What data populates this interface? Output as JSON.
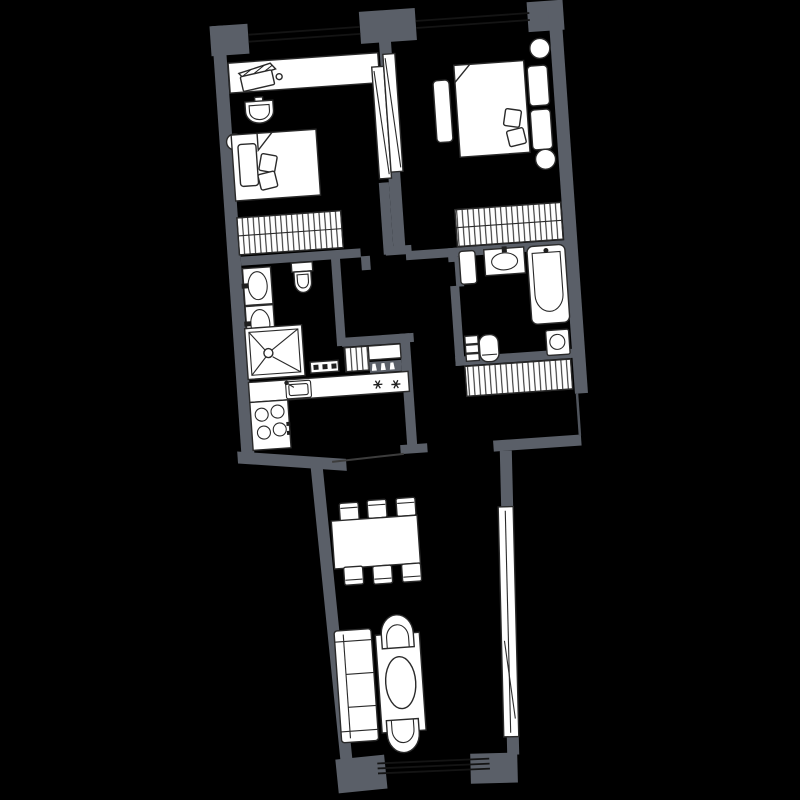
{
  "scene": {
    "kind": "apartment-floor-plan",
    "style": "white line-art furniture on black floor, gray structural walls",
    "rotation_deg": -4
  },
  "colors": {
    "background": "#000000",
    "wall": "#5a5f68",
    "furniture": "#ffffff",
    "outline": "#2a2a2a",
    "glazing": "#141414",
    "accent_dark": "#1f1f1f"
  },
  "rooms": {
    "bedroom_left": {
      "furniture": [
        "desk-console",
        "hatched-mat",
        "tray",
        "pedestal-basin",
        "stool",
        "bed",
        "pillow",
        "cushions",
        "hanger-wardrobe"
      ]
    },
    "bedroom_right": {
      "furniture": [
        "double-bed",
        "pillows",
        "cushions",
        "foot-bench",
        "round-nightstand",
        "round-nightstand",
        "hanger-wardrobe",
        "sliding-door-panels"
      ]
    },
    "bathroom_left": {
      "furniture": [
        "vanity-sink",
        "vanity-sink",
        "toilet",
        "walk-in-shower",
        "shelf-strip"
      ]
    },
    "kitchen": {
      "furniture": [
        "counter-run",
        "kitchen-sink",
        "two-burner-marks",
        "four-burner-stove"
      ]
    },
    "hallway": {
      "furniture": [
        "duct-shaft",
        "console-table",
        "shoe-rack",
        "hanger-closet"
      ]
    },
    "bathroom_right": {
      "furniture": [
        "door-leaf",
        "vanity-sink",
        "bathtub",
        "toilet",
        "shelf-stack",
        "washing-machine"
      ]
    },
    "living_room": {
      "furniture": [
        "dining-table",
        "chair",
        "chair",
        "chair",
        "chair",
        "chair",
        "chair",
        "sofa",
        "coffee-table",
        "oval-top",
        "armchair",
        "armchair",
        "glazed-window-band"
      ]
    }
  },
  "windows": {
    "top_wall": 2,
    "bottom_wall": 1,
    "right_wall": 1
  }
}
